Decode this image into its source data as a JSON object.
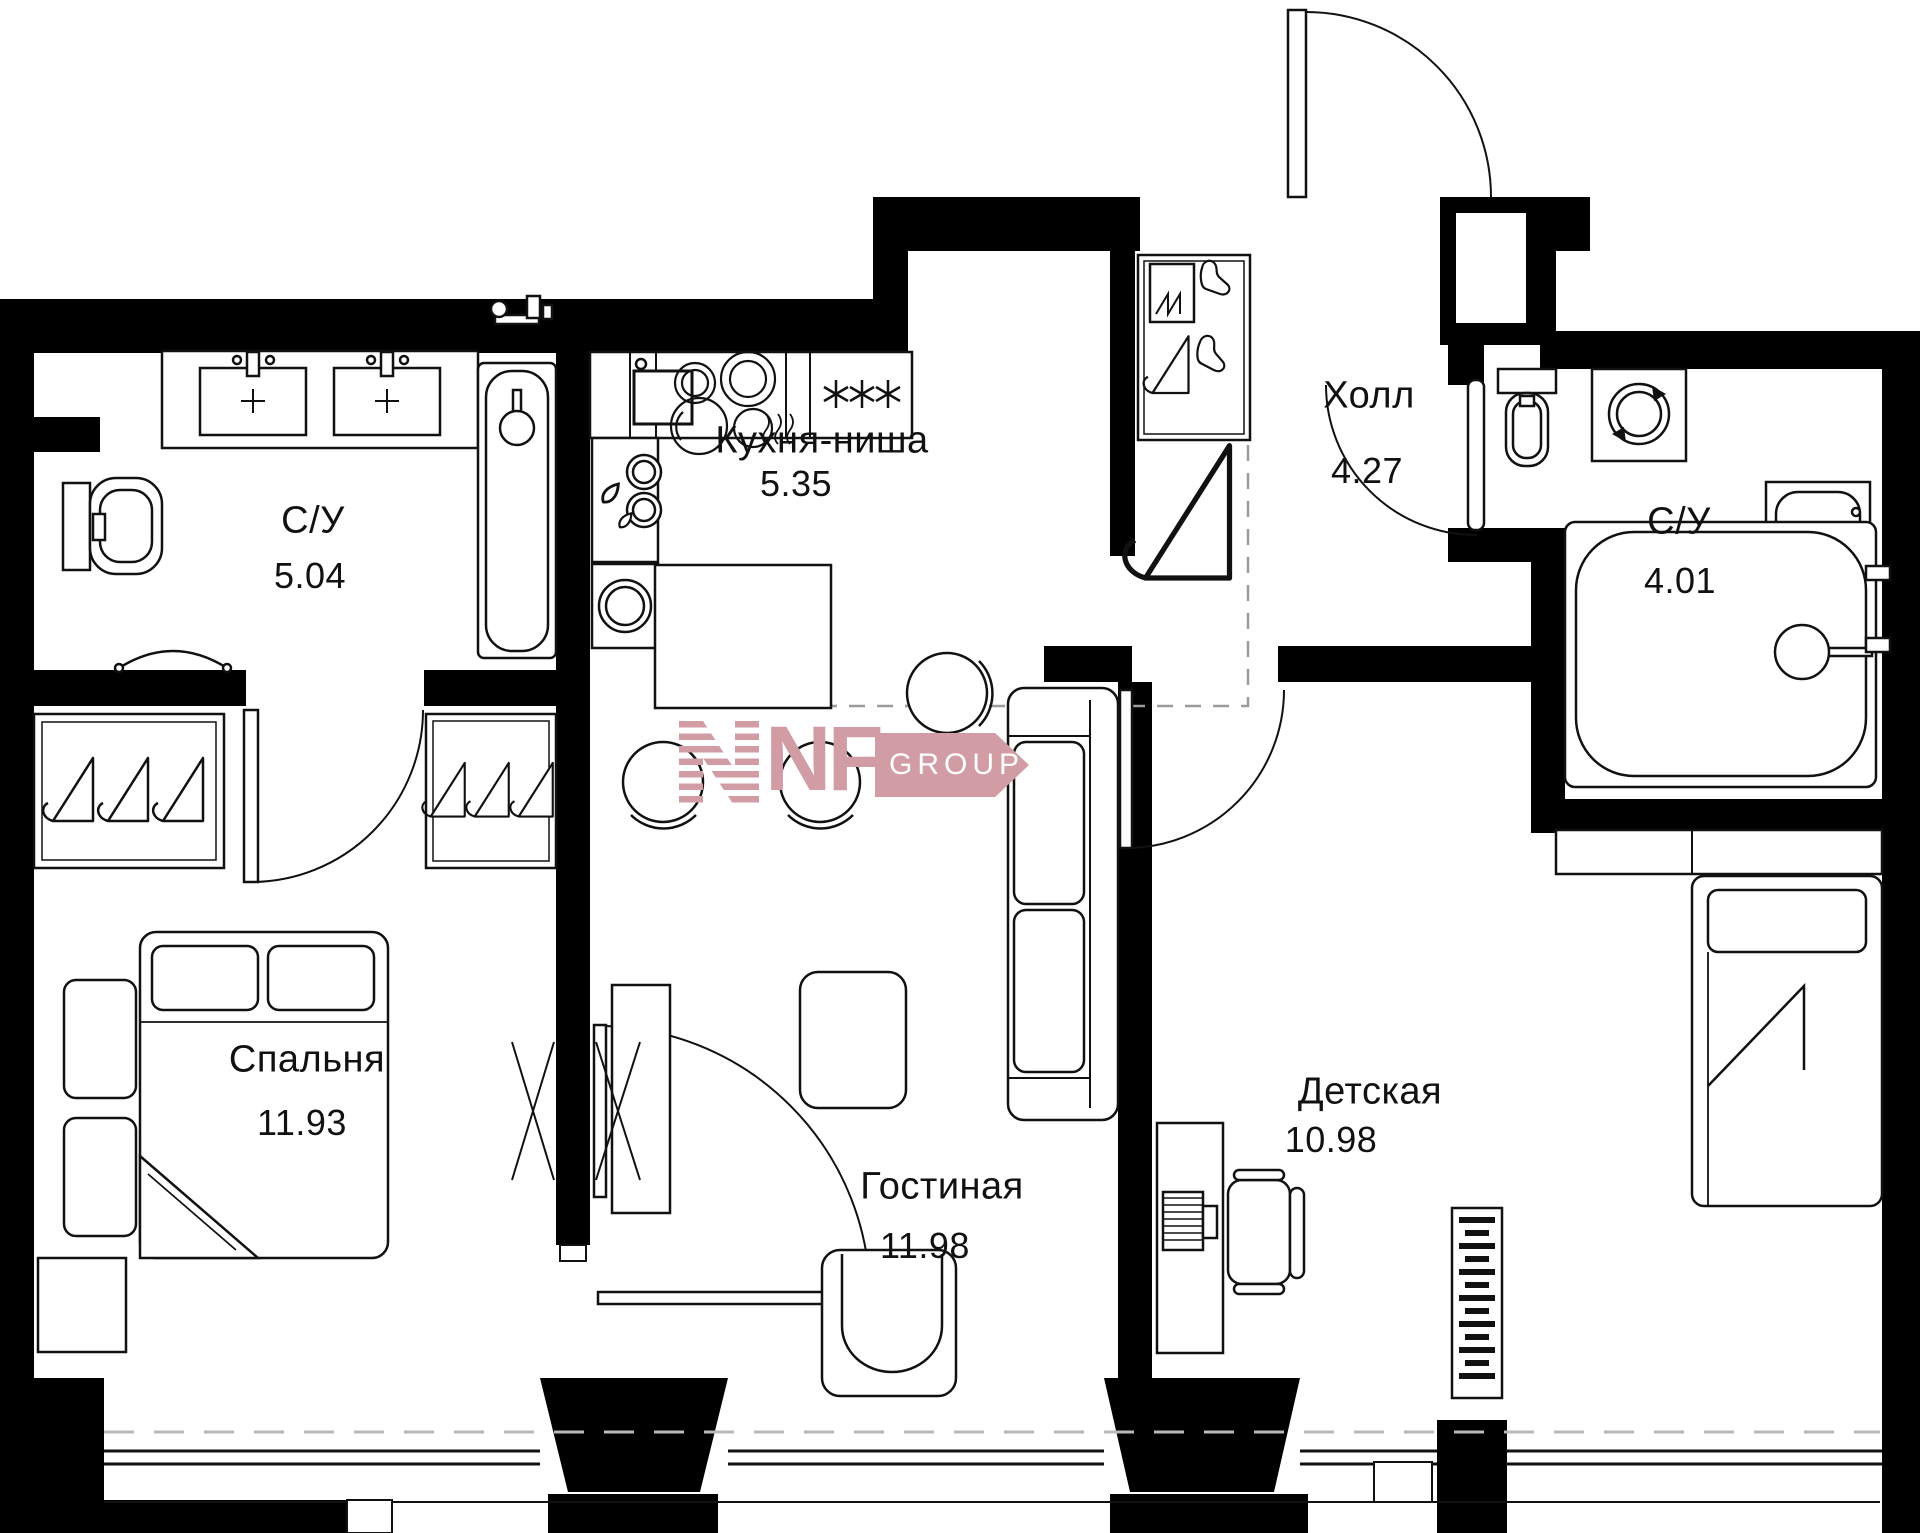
{
  "rooms": {
    "bathroom_1": {
      "label": "С/У",
      "area": "5.04"
    },
    "kitchen": {
      "label": "Кухня-ниша",
      "area": "5.35"
    },
    "hall": {
      "label": "Холл",
      "area": "4.27"
    },
    "bathroom_2": {
      "label": "С/У",
      "area": "4.01"
    },
    "bedroom": {
      "label": "Спальня",
      "area": "11.93"
    },
    "living_room": {
      "label": "Гостиная",
      "area": "11.98"
    },
    "kids_room": {
      "label": "Детская",
      "area": "10.98"
    }
  },
  "watermark": {
    "letters": "NF",
    "word": "GROUP",
    "color": "#d29ca4"
  },
  "icons": {
    "fridge": "three-asterisks",
    "closets": "clothes-hanger",
    "entry_closet": "boots-and-hanger",
    "kitchen_cabinet": "water-drops",
    "bathroom_appliance": "washing-machine-drum",
    "kids_desk": "laptop",
    "kids_wall_unit": "radiator-shelf"
  },
  "colors": {
    "walls": "#000000",
    "lines": "#111111",
    "dashed_zone": "#9b9b9b",
    "dashed_balcony": "#b8b8b8"
  }
}
